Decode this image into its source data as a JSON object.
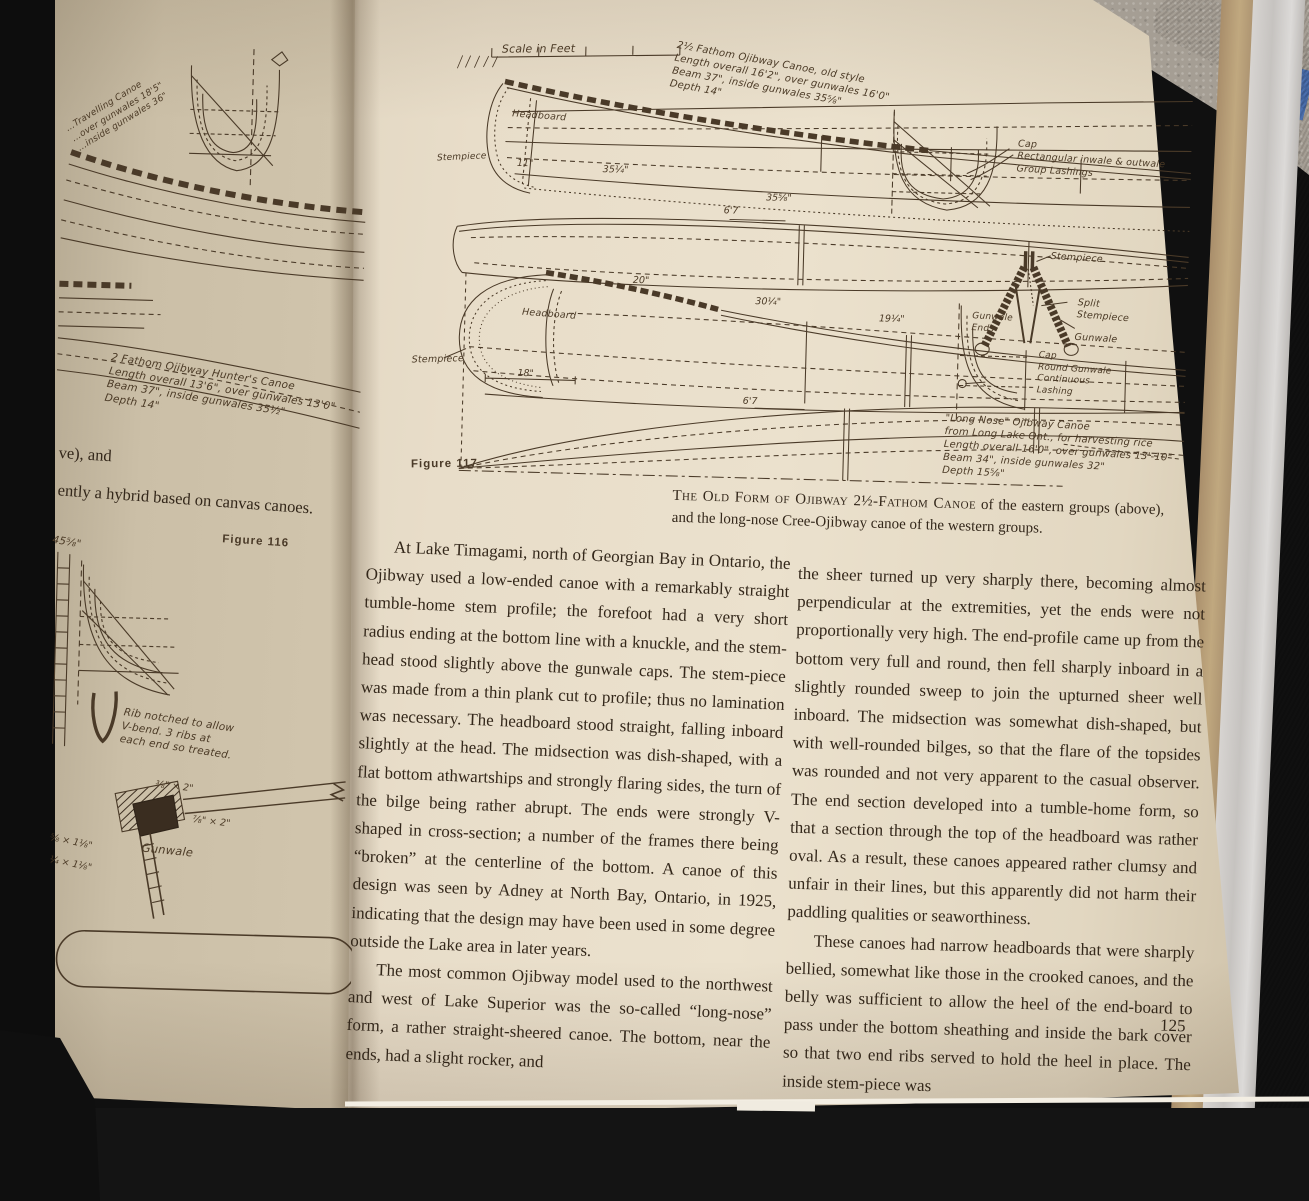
{
  "right_page": {
    "figure_label": "Figure 117",
    "scale_label": "Scale in Feet",
    "old_style_caption": "2½ Fathom Ojibway Canoe, old style\nLength overall 16'2\", over gunwales 16'0\"\nBeam 37\", inside gunwales 35⅝\"\nDepth 14\"",
    "labels": {
      "headboard_top": "Headboard",
      "stempiece_top": "Stempiece",
      "cap_section": "Cap\nRectangular inwale & outwale\nGroup Lashings",
      "dim_11": "11\"",
      "dim_35a": "35¼\"",
      "dim_35b": "35⅝\"",
      "dim_67a": "6'7",
      "dim_20": "20\"",
      "dim_30": "30¼\"",
      "dim_19": "19¼\"",
      "dim_18": "18\"",
      "dim_67b": "6'7",
      "headboard_ln": "Headboard",
      "stempiece_ln": "Stempiece",
      "stempiece_detail": "Stempiece",
      "split_stempiece": "Split\nStempiece",
      "gunwale": "Gunwale",
      "gunwale_ends": "Gunwale\nEnds",
      "round_gunwale": "Cap\nRound Gunwale\nContinuous\nLashing"
    },
    "long_nose_caption": "\"Long Nose\" Ojibway Canoe\nfrom Long Lake Ont., for harvesting rice\nLength overall 16'0\", over gunwales 13'-10\"\nBeam 34\", inside gunwales 32\"\nDepth 15⅝\"",
    "figure_caption": {
      "lead": "The Old Form of Ojibway 2½-Fathom Canoe",
      "rest": " of the eastern groups (above), and the long-nose Cree-Ojibway canoe of the western groups."
    },
    "columns": {
      "left": [
        "At Lake Timagami, north of Georgian Bay in Ontario, the Ojibway used a low-ended canoe with a remarkably straight tumble-home stem profile; the forefoot had a very short radius ending at the bottom line with a knuckle, and the stem-head stood slightly above the gunwale caps.  The stem-piece was made from a thin plank cut to profile; thus no lamination was necessary.  The headboard stood straight, falling inboard slightly at the head.  The midsection was dish-shaped, with a flat bottom athwartships and strongly flaring sides, the turn of the bilge being rather abrupt.  The ends were strongly V-shaped in cross-section; a number of the frames there being “broken” at the centerline of the bottom.  A canoe of this design was seen by Adney at North Bay, Ontario, in 1925, indicating that the design may have been used in some degree outside the Lake area in later years.",
        "The most common Ojibway model used to the northwest and west of Lake Superior was the so-called “long-nose” form, a rather straight-sheered canoe. The bottom, near the ends, had a slight rocker, and"
      ],
      "right": [
        "the sheer turned up very sharply there, becoming almost perpendicular at the extremities, yet the ends were not proportionally very high.  The end-profile came up from the bottom very full and round, then fell sharply inboard in a slightly rounded sweep to join the upturned sheer well inboard.  The midsection was somewhat dish-shaped, but with well-rounded bilges, so that the flare of the topsides was rounded and not very apparent to the casual observer.  The end section developed into a tumble-home form, so that a section through the top of the headboard was rather oval.  As a result, these canoes appeared rather clumsy and unfair in their lines, but this apparently did not harm their paddling qualities or seaworthiness.",
        "These canoes had narrow headboards that were sharply bellied, somewhat like those in the crooked canoes, and the belly was sufficient to allow the heel of the end-board to pass under the bottom sheathing and inside the bark cover so that two end ribs served to hold the heel in place.  The inside stem-piece was"
      ]
    },
    "page_number": "125"
  },
  "left_page": {
    "figure_label": "Figure 116",
    "top_caption_partial": "…Travelling Canoe\n…over gunwales 18'5\"\n…inside gunwales 36\"",
    "hunter_caption": "2 Fathom Ojibway Hunter's Canoe\nLength overall 13'6\", over gunwales 13'0\"\nBeam 37\", inside gunwales 35½\"\nDepth 14\"",
    "text_fragment_1": "ve), and",
    "text_fragment_2": "ently a hybrid based on canvas canoes.",
    "dim_partial": "45⅝\"",
    "rib_note": "Rib notched to allow\nV-bend.  3 ribs at\neach end so treated.",
    "dims": {
      "d1": "⅜\" × 2\"",
      "d2": "⅞\" × 2\"",
      "d3": "⅝ × 1⅛\"",
      "d4": "¼ × 1⅛\""
    },
    "gunwale_label": "Gunwale"
  }
}
